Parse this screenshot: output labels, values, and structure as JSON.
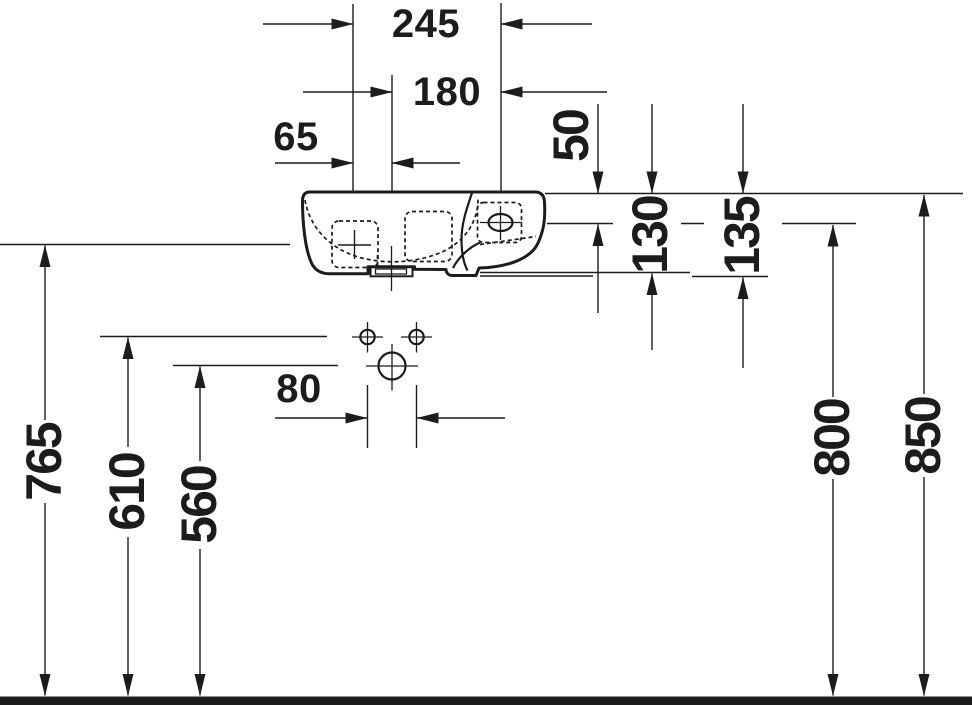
{
  "labels": {
    "width_245": "245",
    "width_180": "180",
    "width_65": "65",
    "offset_50": "50",
    "depth_130": "130",
    "depth_135": "135",
    "hole_spacing_80": "80",
    "height_765": "765",
    "height_610": "610",
    "height_560": "560",
    "height_800": "800",
    "height_850": "850"
  },
  "colors": {
    "ink": "#1c1c1c",
    "background": "#ffffff"
  }
}
